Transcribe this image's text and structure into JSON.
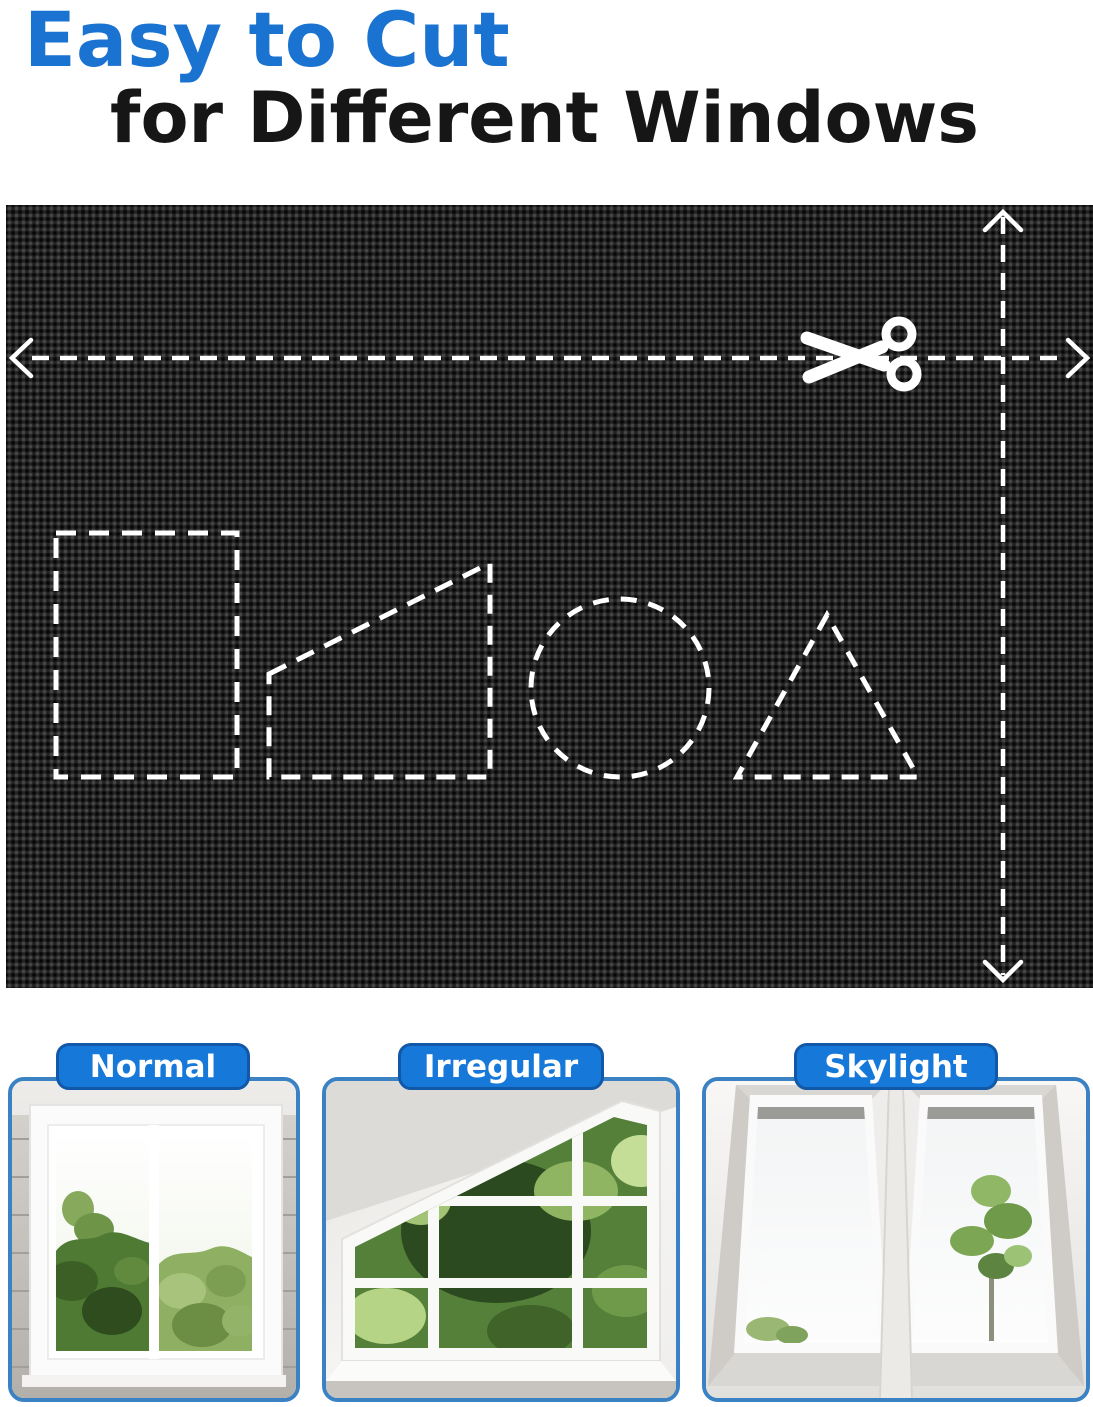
{
  "title": {
    "line1": "Easy to Cut",
    "line2": "for Different Windows"
  },
  "colors": {
    "title_blue": "#1b73d1",
    "title_dark": "#161616",
    "tab_fill": "#1678d8",
    "tab_border": "#1159a8",
    "card_border": "#3b82c4",
    "fabric_base": "#222222",
    "cut_guide_white": "#ffffff"
  },
  "fabric_panel": {
    "icons": [
      "scissors-icon",
      "arrow-left-icon",
      "arrow-right-icon",
      "arrow-up-icon",
      "arrow-down-icon"
    ],
    "cutout_shapes": [
      "rectangle",
      "right-trapezoid",
      "circle",
      "triangle"
    ]
  },
  "window_types": [
    {
      "label": "Normal"
    },
    {
      "label": "Irregular"
    },
    {
      "label": "Skylight"
    }
  ]
}
